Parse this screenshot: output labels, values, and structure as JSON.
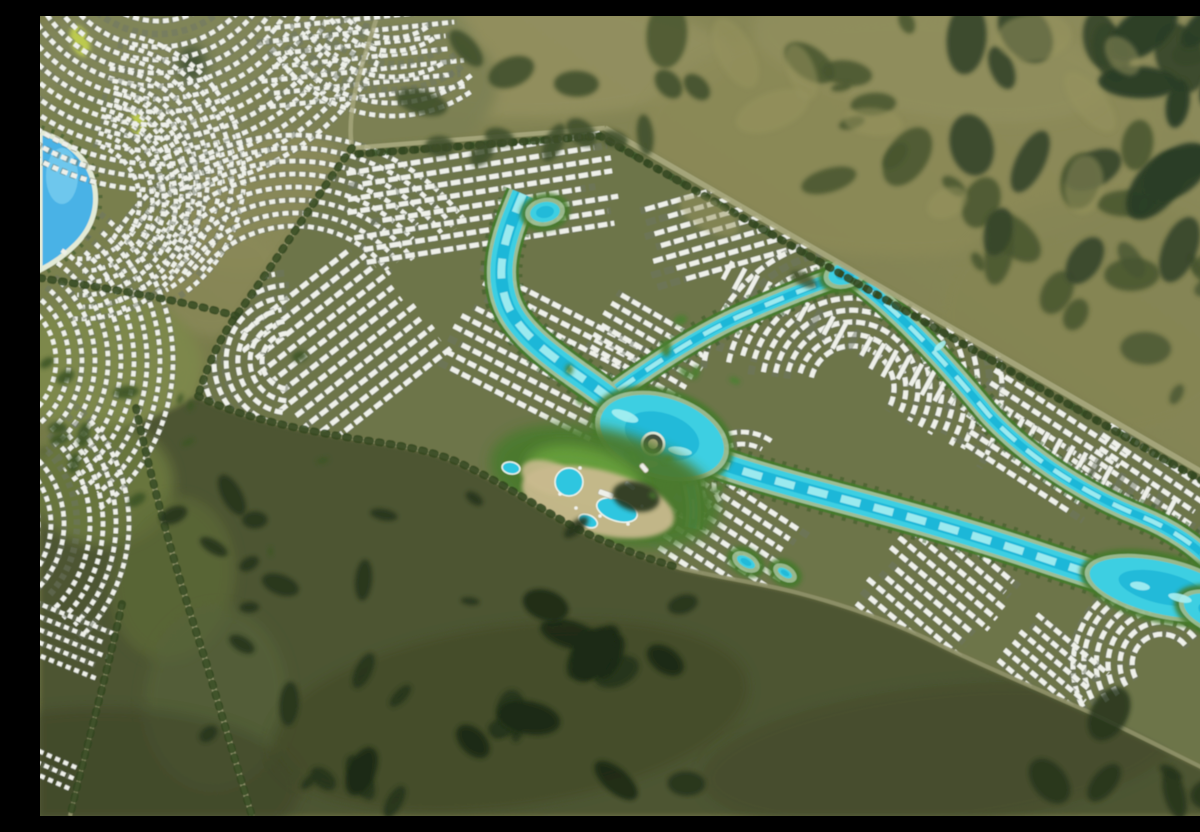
{
  "scene": {
    "title": "aerial-render-lagoon-masterplan-community",
    "kind": "photorealistic aerial rendering, no text overlays",
    "canvas": {
      "w": 1200,
      "h": 800
    }
  },
  "palette": {
    "baseA": "#6e7345",
    "baseB": "#7e8050",
    "baseC": "#8e8c5c",
    "parcelGround": "#6d744a",
    "parcelEdge": "#a8a87e",
    "darkZone": "#4d5430",
    "villaWhite": "#eef0e9",
    "villaShadow": "#6e7566",
    "lagoonWater": "#3ecfe2",
    "lagoonDeep": "#17b0d6",
    "lagoonLight": "#a9eff2",
    "lagoonSand": "#d9edda",
    "lagoonGreen": "#447a2c",
    "lagoonTrees": "#2f5420",
    "leftLagoon": "#49b2e6",
    "leftLagoonLight": "#7fd0f0",
    "beach": "#e3ead6",
    "roadPale": "#a8a87e",
    "roadSoft": "#8f9169",
    "treeLine": "#31471f",
    "parkYellow": "#c3d24e",
    "sandPlaza": "#c9ba8e",
    "poolBlue": "#2fc6e0",
    "islandDark": "#414b42",
    "islandRing": "#e8eee2"
  },
  "background": {
    "gradient": [
      "#6e7345",
      "#7e8050",
      "#8e8c5c"
    ]
  },
  "terrain_patches_under": [
    [
      480,
      42,
      210,
      60,
      0,
      "#93905f",
      0.9
    ],
    [
      860,
      120,
      260,
      120,
      0,
      "#8c8a58",
      0.8
    ],
    [
      1060,
      300,
      160,
      120,
      0,
      "#858552",
      0.7
    ],
    [
      890,
      40,
      180,
      60,
      10,
      "#92905e",
      0.7
    ],
    [
      195,
      55,
      240,
      100,
      -7,
      "#81865a",
      0.95
    ],
    [
      330,
      85,
      130,
      75,
      -12,
      "#7b8052",
      0.9
    ],
    [
      58,
      175,
      95,
      108,
      0,
      "#79804f",
      0.95
    ],
    [
      52,
      332,
      86,
      95,
      0,
      "#7a8150",
      0.9
    ],
    [
      42,
      490,
      76,
      86,
      0,
      "#747c4a",
      0.85
    ],
    [
      28,
      627,
      56,
      62,
      0,
      "#747c4a",
      0.8
    ],
    [
      225,
      185,
      88,
      62,
      -30,
      "#8b8a5a",
      0.85
    ],
    [
      182,
      266,
      62,
      50,
      -35,
      "#8a8958",
      0.8
    ],
    [
      70,
      352,
      92,
      72,
      0,
      "#7e8a4c",
      0.8
    ]
  ],
  "terrain_patches_over": [
    [
      62,
      468,
      72,
      62,
      0,
      "#6d7a40",
      0.85
    ],
    [
      132,
      562,
      62,
      82,
      8,
      "#5f6c38",
      0.7
    ],
    [
      176,
      682,
      72,
      92,
      5,
      "#57633a",
      0.6
    ],
    [
      60,
      772,
      200,
      80,
      0,
      "#3a4226",
      0.5
    ],
    [
      470,
      700,
      240,
      90,
      -8,
      "#3f4827",
      0.6
    ],
    [
      900,
      740,
      240,
      70,
      -6,
      "#424a29",
      0.5
    ]
  ],
  "dark_zone": {
    "path": "M158,380 C200,402 270,416 330,425 C380,432 408,440 430,452 C468,470 505,496 540,514 C575,531 608,543 640,552 C680,562 722,567 762,578 C815,592 862,610 902,630 C952,654 1010,678 1062,702 C1112,726 1162,752 1200,770 L1200,800 L0,800 L0,432 C60,424 118,402 158,380 Z"
  },
  "parcel": {
    "path": "M312,132 L565,112 L1200,478 L1200,770 C1162,752 1112,726 1062,702 C1010,678 952,654 902,630 C862,610 815,592 762,578 C722,567 680,562 640,552 C608,543 575,531 540,514 C505,496 468,470 430,452 C408,440 380,432 330,425 C270,416 200,402 158,380 C168,348 180,322 196,300 C220,265 262,204 312,132 Z"
  },
  "left_lagoon": {
    "path": "M0,116 C26,124 46,140 53,164 C60,190 52,212 36,228 C22,242 8,250 0,254 Z"
  },
  "park_leaf": [
    [
      40,
      25,
      9,
      16,
      -20
    ],
    [
      98,
      108,
      7,
      12,
      -10
    ]
  ],
  "roads": [
    {
      "name": "road-north-edge",
      "d": "M312,132 L565,112",
      "w": 4.5,
      "c": "#a8a87e",
      "o": 0.9
    },
    {
      "name": "road-ne-boundary",
      "d": "M565,112 L1200,478",
      "w": 5.5,
      "c": "#a8a87e",
      "o": 0.9
    },
    {
      "name": "road-west-corridor",
      "d": "M336,4 C320,54 306,96 312,132",
      "w": 4.5,
      "c": "#a8a87e",
      "o": 0.8
    },
    {
      "name": "road-parcel-west",
      "d": "M312,132 C282,172 240,240 196,300 C180,322 168,348 158,380",
      "w": 4,
      "c": "#a8a87e",
      "o": 0.85
    },
    {
      "name": "road-shoreline",
      "d": "M158,380 C200,402 270,416 330,425 C380,432 408,440 430,452 C468,470 505,496 540,514 C575,531 608,543 640,552 C680,562 722,567 762,578 C815,592 862,610 902,630 C952,654 1010,678 1062,702 C1112,726 1162,752 1200,770",
      "w": 4,
      "c": "#8f9169",
      "o": 0.9
    },
    {
      "name": "road-left-curve",
      "d": "M96,392 C112,468 136,556 166,646 C182,700 198,754 212,800",
      "w": 5,
      "c": "#a8a87e",
      "o": 0.8
    },
    {
      "name": "road-left-small",
      "d": "M82,588 C68,654 48,724 30,800",
      "w": 4,
      "c": "#a8a87e",
      "o": 0.7
    },
    {
      "name": "road-link-west",
      "d": "M0,262 C64,272 132,282 196,300",
      "w": 4,
      "c": "#a8a87e",
      "o": 0.7
    }
  ],
  "tree_lines": [
    "M312,132 C282,172 240,240 196,300 C180,322 168,348 158,380",
    "M158,380 C200,402 270,416 330,425 C380,432 408,440 430,452 C468,470 505,496 540,514 C575,531 608,543 640,552",
    "M96,392 C112,468 136,556 166,646 C182,700 198,754 212,800",
    "M82,588 C68,654 48,724 30,800",
    "M0,262 C64,272 132,282 196,300",
    "M318,138 L560,120 L1192,482"
  ],
  "lagoon": {
    "channels": [
      {
        "name": "lagoon-trunk",
        "d": "M483,178 C468,214 452,252 468,290 C482,322 520,346 556,372 C586,394 602,408 622,421 C662,444 704,456 762,472 C832,491 902,508 1012,545 C1082,568 1140,586 1200,606",
        "w": 22
      },
      {
        "name": "lagoon-ne-arm",
        "d": "M578,374 C620,344 660,318 700,300 C740,283 775,268 808,258 C850,286 900,340 948,398 C990,444 1050,480 1100,500 C1130,512 1158,530 1176,552",
        "w": 13
      },
      {
        "name": "lagoon-south-arm",
        "d": "M645,450 C652,472 656,492 652,512",
        "w": 8
      }
    ],
    "pools": [
      [
        622,
        420,
        64,
        38,
        18
      ],
      [
        505,
        196,
        15,
        10,
        -10
      ],
      [
        1122,
        572,
        74,
        26,
        13
      ],
      [
        1180,
        598,
        38,
        17,
        20
      ],
      [
        806,
        257,
        18,
        11,
        -18
      ]
    ],
    "ponds": [
      [
        706,
        546,
        10,
        5,
        30
      ],
      [
        745,
        557,
        8,
        4,
        32
      ]
    ],
    "sparkles": [
      [
        1100,
        570,
        10,
        4,
        10
      ],
      [
        1140,
        582,
        12,
        4,
        14
      ],
      [
        585,
        400,
        14,
        5,
        20
      ],
      [
        640,
        435,
        12,
        4,
        10
      ],
      [
        608,
        448,
        10,
        4,
        0
      ],
      [
        900,
        330,
        7,
        3,
        -40
      ]
    ],
    "island": {
      "x": 613,
      "y": 428,
      "r": 11
    }
  },
  "amenity": {
    "green_base": [
      565,
      470,
      118,
      56,
      15,
      "#4b7a2f",
      0.95
    ],
    "green_bright": [
      545,
      462,
      60,
      30,
      15,
      "#69a23e",
      0.9
    ],
    "sand": [
      [
        558,
        486,
        78,
        32,
        14,
        0.95
      ],
      [
        510,
        462,
        30,
        16,
        20,
        0.9
      ]
    ],
    "pools": [
      [
        529,
        466,
        14,
        14,
        0
      ],
      [
        577,
        494,
        21,
        11,
        18
      ],
      [
        548,
        505,
        10,
        6,
        25
      ],
      [
        471,
        452,
        9,
        6,
        10
      ]
    ],
    "buildings": [
      [
        566,
        478,
        16,
        6,
        20
      ],
      [
        590,
        470,
        12,
        5,
        35
      ],
      [
        604,
        452,
        10,
        5,
        50
      ]
    ],
    "cabanas": [
      [
        520,
        478
      ],
      [
        536,
        492
      ],
      [
        560,
        500
      ],
      [
        588,
        508
      ],
      [
        602,
        490
      ],
      [
        540,
        452
      ]
    ]
  },
  "clusters": [
    {
      "kind": "arc",
      "name": "tl-fan",
      "cx": 118,
      "cy": -78,
      "r0": 70,
      "r1": 255,
      "step": 13,
      "a0": 25,
      "a1": 150,
      "dash": "6 4",
      "w": 4.6,
      "clip": false,
      "seed": 41
    },
    {
      "kind": "arc",
      "name": "tl-fan2",
      "cx": 60,
      "cy": 160,
      "r0": 60,
      "r1": 150,
      "step": 12,
      "a0": -80,
      "a1": 55,
      "dash": "5.5 4",
      "w": 4.4,
      "clip": false,
      "seed": 43
    },
    {
      "kind": "rows",
      "name": "tl-rows",
      "cx": 320,
      "cy": 42,
      "angle": -6,
      "len": 185,
      "count": 7,
      "gap": 13,
      "dash": "6 4",
      "w": 4.6,
      "clip": false,
      "seed": 45
    },
    {
      "kind": "arc",
      "name": "tl-arc-east",
      "cx": 352,
      "cy": -40,
      "r0": 62,
      "r1": 145,
      "step": 13,
      "a0": 55,
      "a1": 150,
      "dash": "6 4",
      "w": 4.5,
      "clip": false,
      "seed": 47
    },
    {
      "kind": "arc",
      "name": "tl-arc-south",
      "cx": 255,
      "cy": 330,
      "r0": 120,
      "r1": 215,
      "step": 13,
      "a0": 215,
      "a1": 320,
      "dash": "6 4",
      "w": 4.5,
      "clip": false,
      "seed": 49
    },
    {
      "kind": "arc",
      "name": "left-lagoon-wrap",
      "cx": 42,
      "cy": 185,
      "r0": 58,
      "r1": 122,
      "step": 12,
      "a0": -75,
      "a1": 95,
      "dash": "5 4",
      "w": 4.4,
      "clip": false,
      "seed": 51
    },
    {
      "kind": "arc",
      "name": "left-mid",
      "cx": -52,
      "cy": 345,
      "r0": 68,
      "r1": 185,
      "step": 13,
      "a0": -52,
      "a1": 52,
      "dash": "5.5 4",
      "w": 4.5,
      "clip": false,
      "seed": 53
    },
    {
      "kind": "arc",
      "name": "left-low",
      "cx": -68,
      "cy": 508,
      "r0": 66,
      "r1": 168,
      "step": 13,
      "a0": -45,
      "a1": 45,
      "dash": "5.5 4",
      "w": 4.5,
      "clip": false,
      "seed": 55
    },
    {
      "kind": "rows",
      "name": "left-bottom",
      "cx": 20,
      "cy": 622,
      "angle": 22,
      "len": 92,
      "count": 5,
      "gap": 12,
      "dash": "5 4",
      "w": 4.3,
      "clip": false,
      "seed": 57
    },
    {
      "kind": "rows",
      "name": "left-corner",
      "cx": 10,
      "cy": 752,
      "angle": 24,
      "len": 55,
      "count": 3,
      "gap": 11,
      "dash": "5 4",
      "w": 4.2,
      "clip": false,
      "seed": 59
    },
    {
      "kind": "rows",
      "name": "p-nw",
      "cx": 442,
      "cy": 182,
      "angle": -9,
      "len": 235,
      "count": 8,
      "gap": 13,
      "dash": "9.5 3.5",
      "w": 5,
      "clip": true,
      "seed": 61
    },
    {
      "kind": "rows",
      "name": "p-west-fan",
      "cx": 300,
      "cy": 330,
      "angle": -38,
      "len": 150,
      "count": 11,
      "gap": 14,
      "dash": "9 3.5",
      "w": 5,
      "clip": true,
      "seed": 63
    },
    {
      "kind": "arc",
      "name": "p-west-tip",
      "cx": 250,
      "cy": 345,
      "r0": 28,
      "r1": 90,
      "step": 12,
      "a0": 95,
      "a1": 265,
      "dash": "8 4",
      "w": 4.8,
      "clip": true,
      "seed": 65
    },
    {
      "kind": "rows",
      "name": "p-center",
      "cx": 505,
      "cy": 342,
      "angle": 27,
      "len": 172,
      "count": 9,
      "gap": 13,
      "dash": "9 3.5",
      "w": 5,
      "clip": true,
      "seed": 67
    },
    {
      "kind": "rows",
      "name": "p-ne",
      "cx": 752,
      "cy": 192,
      "angle": -16,
      "len": 268,
      "count": 7,
      "gap": 13,
      "dash": "10 3.5",
      "w": 5,
      "clip": true,
      "seed": 69
    },
    {
      "kind": "rows",
      "name": "p-mid-n",
      "cx": 610,
      "cy": 330,
      "angle": 30,
      "len": 100,
      "count": 6,
      "gap": 12,
      "dash": "9 3.5",
      "w": 4.8,
      "clip": true,
      "seed": 71
    },
    {
      "kind": "arc",
      "name": "p-east-swirl",
      "cx": 812,
      "cy": 372,
      "r0": 42,
      "r1": 152,
      "step": 12,
      "a0": 192,
      "a1": 388,
      "dash": "9 4",
      "w": 5,
      "clip": true,
      "seed": 73
    },
    {
      "kind": "rows",
      "name": "p-fareast",
      "cx": 1000,
      "cy": 430,
      "angle": 33,
      "len": 140,
      "count": 7,
      "gap": 13,
      "dash": "9 3.5",
      "w": 5,
      "clip": true,
      "seed": 75
    },
    {
      "kind": "rows",
      "name": "p-east-edge",
      "cx": 1105,
      "cy": 470,
      "angle": 34,
      "len": 128,
      "count": 6,
      "gap": 12.5,
      "dash": "9 3.5",
      "w": 4.8,
      "clip": true,
      "seed": 77
    },
    {
      "kind": "picket",
      "name": "p-road-strip",
      "x1": 694,
      "y1": 243,
      "x2": 1136,
      "y2": 482,
      "count": 36,
      "len": 25,
      "w": 4.5,
      "clip": true,
      "seed": 79
    },
    {
      "kind": "rows",
      "name": "p-south1",
      "cx": 688,
      "cy": 522,
      "angle": 33,
      "len": 122,
      "count": 8,
      "gap": 13,
      "dash": "9 3.5",
      "w": 5,
      "clip": true,
      "seed": 81
    },
    {
      "kind": "rows",
      "name": "p-south2",
      "cx": 888,
      "cy": 588,
      "angle": 40,
      "len": 112,
      "count": 12,
      "gap": 13,
      "dash": "9 3.5",
      "w": 5,
      "clip": true,
      "seed": 83
    },
    {
      "kind": "arc",
      "name": "p-se-swirl",
      "cx": 1122,
      "cy": 648,
      "r0": 30,
      "r1": 94,
      "step": 12,
      "a0": 150,
      "a1": 325,
      "dash": "9 4",
      "w": 5,
      "clip": true,
      "seed": 85
    },
    {
      "kind": "rows",
      "name": "p-se-rows",
      "cx": 1012,
      "cy": 650,
      "angle": 40,
      "len": 88,
      "count": 6,
      "gap": 12,
      "dash": "8 3.5",
      "w": 4.8,
      "clip": true,
      "seed": 87
    },
    {
      "kind": "arc",
      "name": "p-amenity-arc",
      "cx": 702,
      "cy": 468,
      "r0": 28,
      "r1": 56,
      "step": 12,
      "a0": 140,
      "a1": 300,
      "dash": "8 4",
      "w": 4.6,
      "clip": true,
      "seed": 89
    }
  ],
  "scatters": [
    [
      620,
      0,
      1200,
      300,
      26,
      10,
      34,
      "#46552e",
      0.85,
      7
    ],
    [
      920,
      0,
      1180,
      290,
      12,
      16,
      40,
      "#36452a",
      0.9,
      11
    ],
    [
      1080,
      0,
      1200,
      180,
      8,
      20,
      48,
      "#2c3c25",
      0.95,
      3
    ],
    [
      340,
      30,
      680,
      150,
      13,
      10,
      26,
      "#3e4d2c",
      0.85,
      5
    ],
    [
      130,
      470,
      660,
      790,
      30,
      8,
      26,
      "#26341b",
      0.9,
      13
    ],
    [
      300,
      580,
      640,
      780,
      10,
      18,
      42,
      "#1f2c17",
      0.9,
      17
    ],
    [
      0,
      340,
      300,
      560,
      14,
      5,
      14,
      "#3c5425",
      0.9,
      19
    ],
    [
      1080,
      230,
      1200,
      430,
      7,
      10,
      26,
      "#465530",
      0.8,
      23
    ],
    [
      650,
      20,
      1180,
      260,
      10,
      20,
      50,
      "#97945f",
      0.5,
      29
    ],
    [
      1000,
      690,
      1200,
      795,
      6,
      12,
      30,
      "#26341b",
      0.85,
      31
    ],
    [
      520,
      300,
      700,
      480,
      12,
      4,
      9,
      "#4c8030",
      0.9,
      37
    ]
  ],
  "extra_patches": [
    [
      152,
      48,
      14,
      18,
      0,
      "#3e5030",
      0.9
    ]
  ]
}
